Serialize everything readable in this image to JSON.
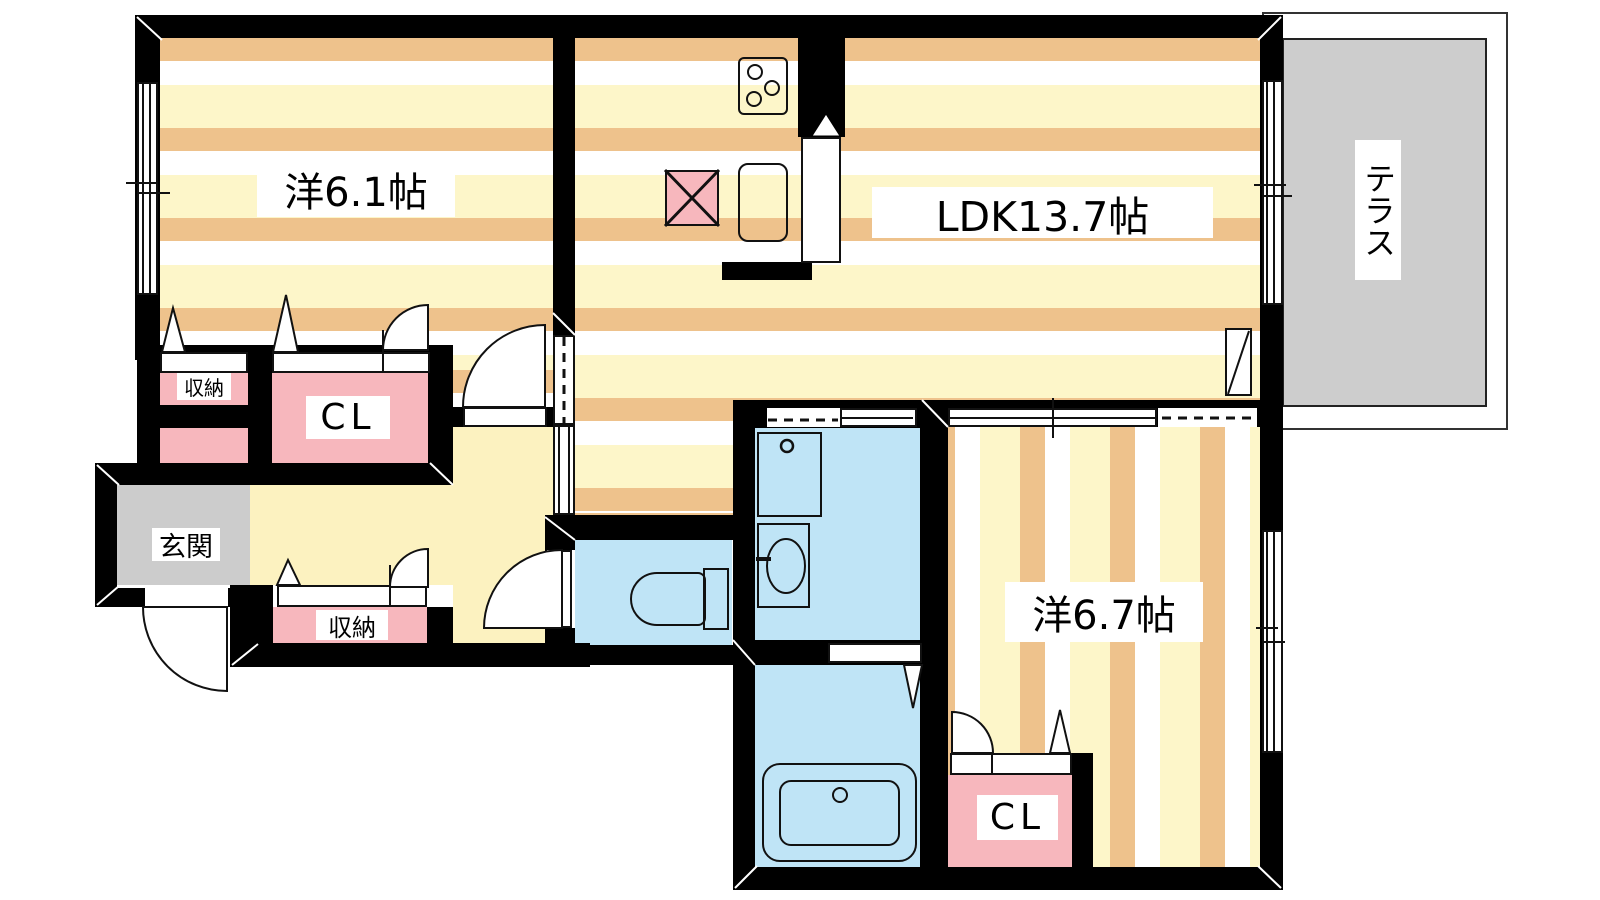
{
  "title": "apartment floor plan",
  "rooms": {
    "western1": {
      "label": "洋6.1帖"
    },
    "ldk": {
      "label": "LDK13.7帖"
    },
    "western2": {
      "label": "洋6.7帖"
    },
    "terrace": {
      "label": "テラス"
    },
    "entrance": {
      "label": "玄関"
    },
    "storage_upper": {
      "label": "収納"
    },
    "storage_lower": {
      "label": "収納"
    },
    "closet_upper": {
      "label": "CL"
    },
    "closet_lower": {
      "label": "CL"
    }
  },
  "colors": {
    "wall": "#000000",
    "floor_stripe_tan": "#eec28c",
    "floor_stripe_cream": "#fdf6c9",
    "hallway_cream": "#fcf2c0",
    "water_area_blue": "#bfe4f6",
    "closet_pink": "#f7b7bd",
    "terrace_gray": "#cdcdcd",
    "entrance_gray": "#cccccc"
  }
}
